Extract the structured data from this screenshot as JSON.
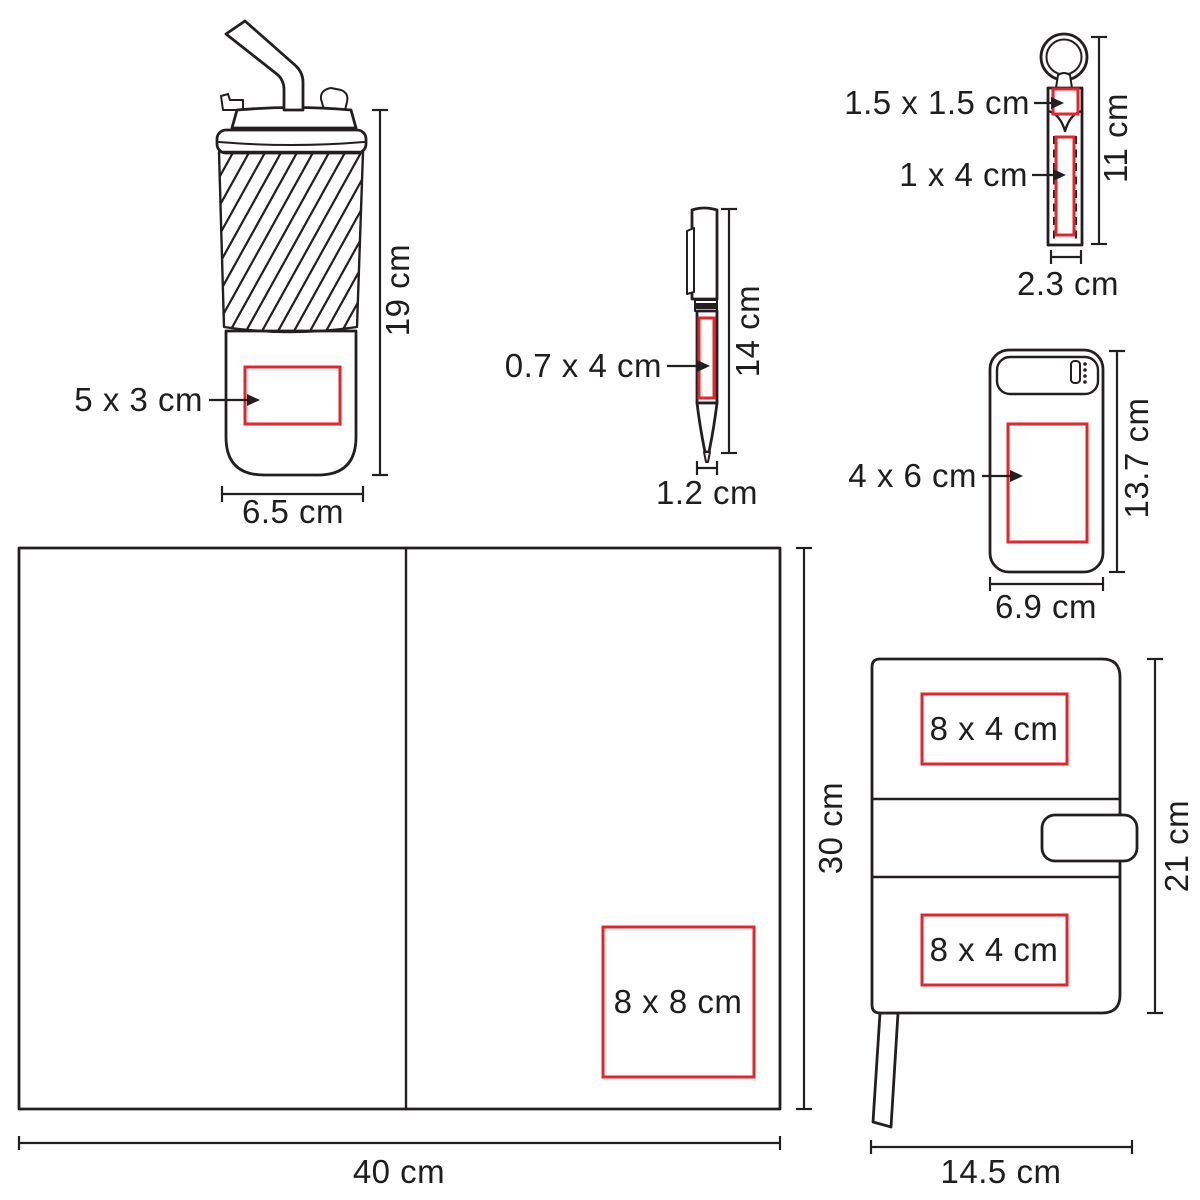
{
  "page": {
    "background_color": "#ffffff",
    "line_color": "#231f20",
    "accent_red": "#e62429",
    "unit": "cm"
  },
  "products": [
    {
      "id": "tumbler",
      "print_area_label": "5 x 3 cm",
      "height_label": "19 cm",
      "width_label": "6.5 cm"
    },
    {
      "id": "pen",
      "print_area_label": "0.7 x 4 cm",
      "height_label": "14 cm",
      "width_label": "1.2 cm"
    },
    {
      "id": "keychain",
      "print_area_top_label": "1.5 x 1.5 cm",
      "print_area_body_label": "1 x 4 cm",
      "height_label": "11 cm",
      "width_label": "2.3 cm"
    },
    {
      "id": "power-bank",
      "print_area_label": "4 x 6 cm",
      "height_label": "13.7 cm",
      "width_label": "6.9 cm"
    },
    {
      "id": "open-notebook",
      "print_area_label": "8 x 8 cm",
      "height_label": "30 cm",
      "width_label": "40 cm"
    },
    {
      "id": "notebook",
      "print_area_top_label": "8 x 4 cm",
      "print_area_bottom_label": "8 x 4 cm",
      "height_label": "21 cm",
      "width_label": "14.5 cm"
    }
  ]
}
